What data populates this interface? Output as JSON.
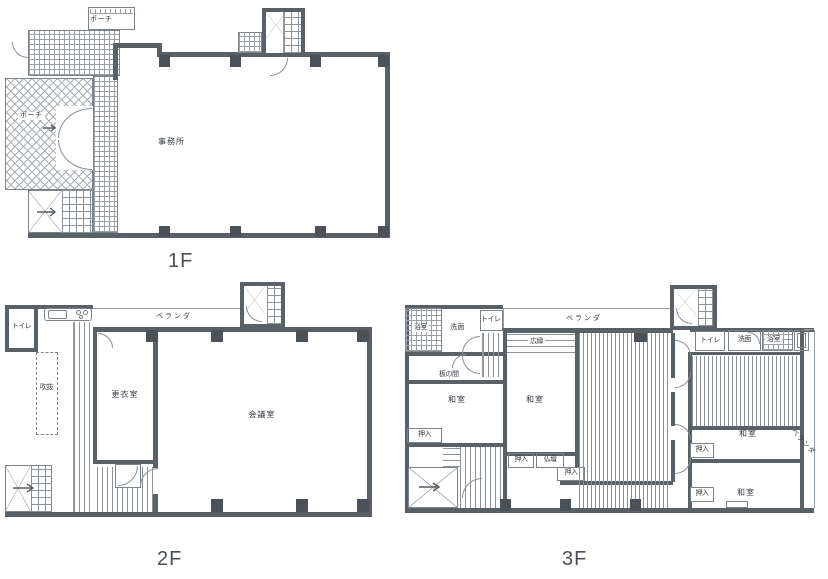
{
  "colors": {
    "wall": "#5a6067",
    "column": "#4b5157",
    "line": "#979da3",
    "text": "#343a40"
  },
  "floor1": {
    "title": "1F",
    "office": "事務所",
    "porch_canopy": "ポーチ",
    "porch": "ポーチ"
  },
  "floor2": {
    "title": "2F",
    "toilet": "トイレ",
    "veranda": "ベランダ",
    "void": "吹抜",
    "changing_room": "更衣室",
    "meeting_room": "会議室"
  },
  "floor3": {
    "title": "3F",
    "bath_left": "浴室",
    "washroom_left": "洗面",
    "toilet_left": "トイレ",
    "veranda_top": "ベランダ",
    "hiroen": "広縁",
    "itanoma": "板の間",
    "washitsu_a": "和室",
    "washitsu_b": "和室",
    "oshiire_a": "押入",
    "oshiire_b": "押入",
    "butsudan": "仏壇",
    "oshiire_c": "押入",
    "toilet_right": "トイレ",
    "washroom_right": "洗面",
    "bath_right": "浴室",
    "washitsu_c": "和室",
    "oshiire_d": "押入",
    "washitsu_d": "和室",
    "oshiire_e": "押入",
    "veranda_right": "ベランダ"
  }
}
